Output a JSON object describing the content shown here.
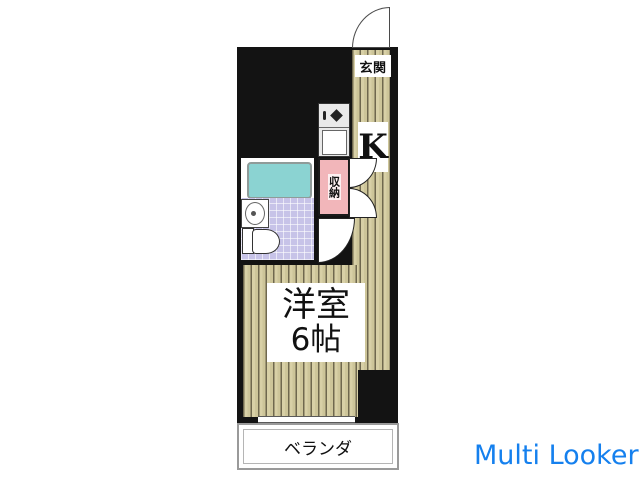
{
  "floorplan": {
    "entrance_label": "玄関",
    "kitchen_label": "K",
    "storage_label": "収納",
    "room_label_line1": "洋室",
    "room_label_line2": "6帖",
    "balcony_label": "ベランダ"
  },
  "watermark": {
    "text": "Multi Looker"
  },
  "colors": {
    "wall": "#131313",
    "floor-base": "#d8d0a6",
    "floor-stripe": "#6f684e",
    "storage-pink": "#f2b6ba",
    "bathtub-cyan": "#8bd3d2",
    "tile-purple": "#c7c3e8",
    "veranda-border": "#9a9a9a",
    "watermark-blue": "#1580ee"
  }
}
